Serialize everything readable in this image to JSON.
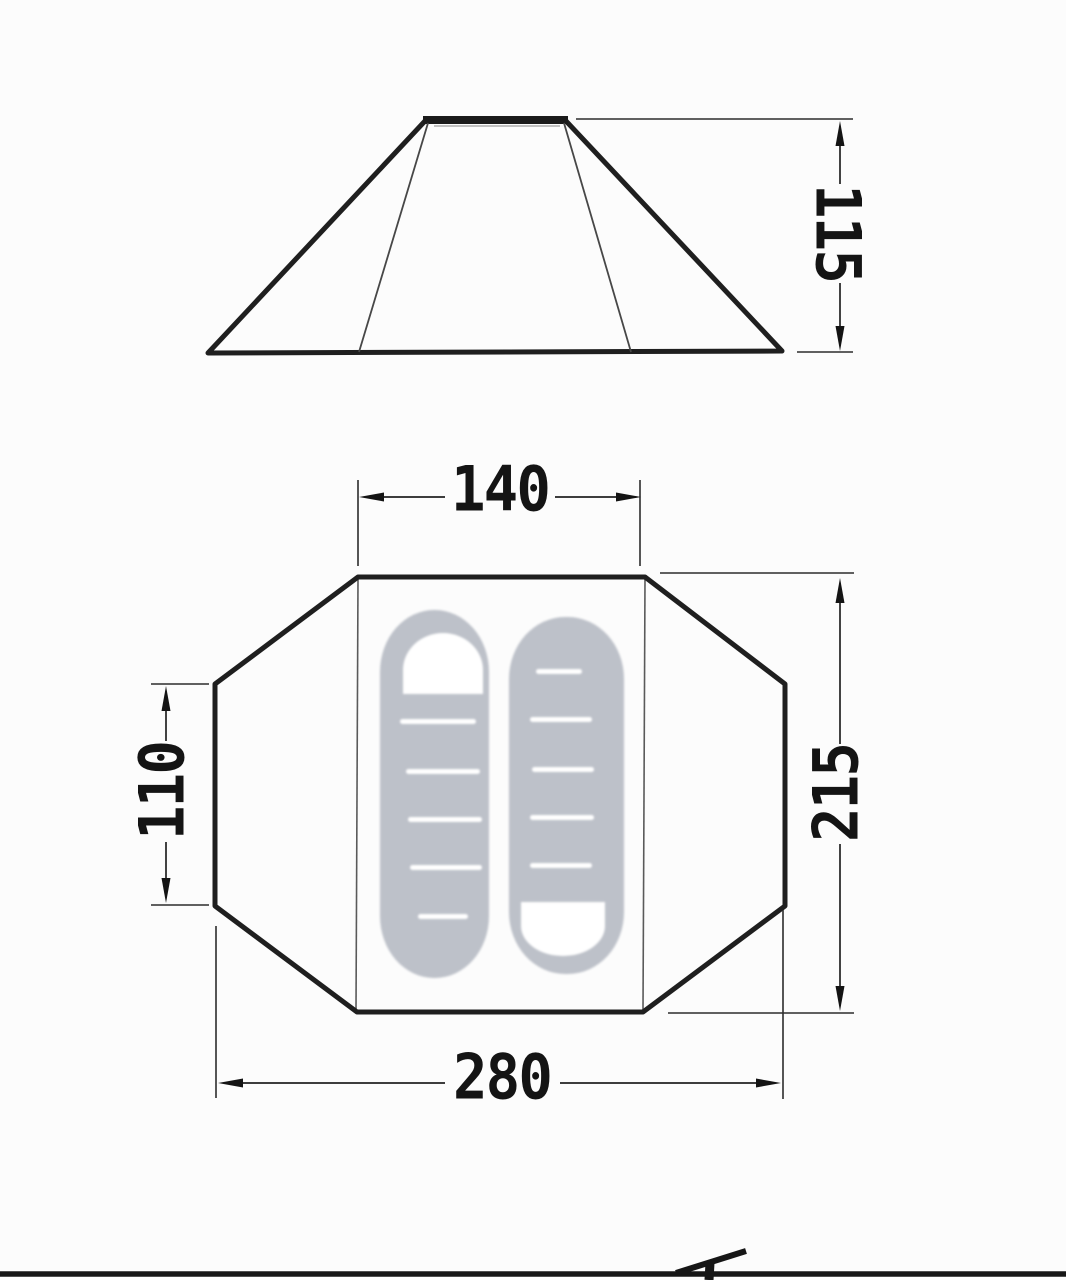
{
  "diagram": {
    "side_view": {
      "height_value": "115"
    },
    "floor_plan": {
      "inner_width_value": "140",
      "side_section_value": "110",
      "total_depth_value": "215",
      "total_width_value": "280"
    }
  },
  "colors": {
    "outline": "#1f1f1f",
    "dimension_line": "#222222",
    "text": "#141414",
    "mat_fill": "#bdc1c9",
    "mat_detail": "#ffffff",
    "background": "#fcfcfc"
  }
}
